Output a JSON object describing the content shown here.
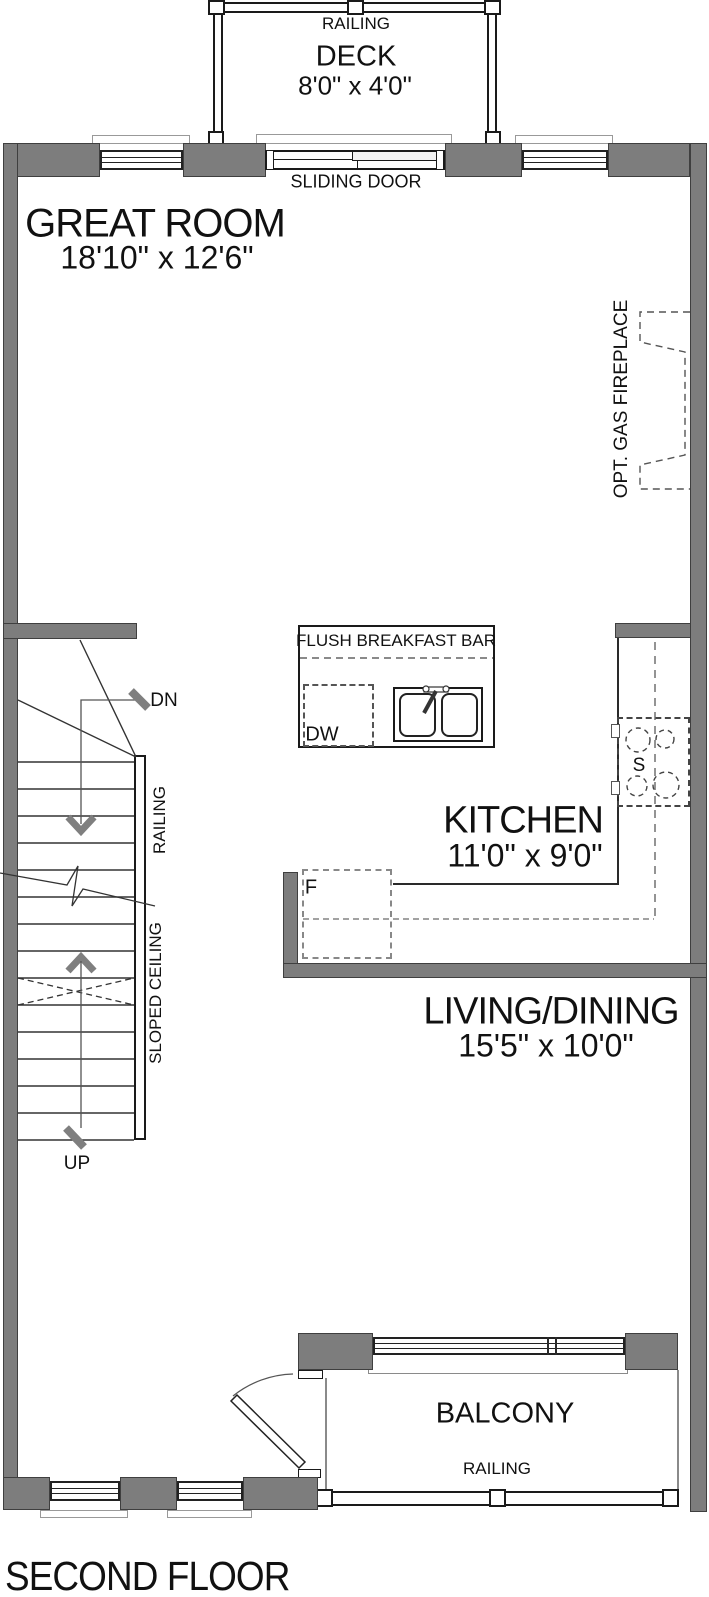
{
  "title": "SECOND FLOOR",
  "deck": {
    "name": "DECK",
    "dims": "8'0\" x 4'0\"",
    "railing": "RAILING"
  },
  "great_room": {
    "name": "GREAT ROOM",
    "dims": "18'10\" x 12'6\""
  },
  "doors": {
    "sliding": "SLIDING DOOR"
  },
  "fireplace": {
    "label": "OPT. GAS FIREPLACE"
  },
  "kitchen": {
    "name": "KITCHEN",
    "dims": "11'0\" x 9'0\"",
    "breakfast_bar": "FLUSH BREAKFAST BAR",
    "dishwasher": "DW",
    "fridge": "F",
    "stove": "S"
  },
  "living_dining": {
    "name": "LIVING/DINING",
    "dims": "15'5\" x 10'0\""
  },
  "stairs": {
    "down": "DN",
    "up": "UP",
    "railing": "RAILING",
    "sloped_ceiling": "SLOPED CEILING"
  },
  "balcony": {
    "name": "BALCONY",
    "railing": "RAILING"
  },
  "colors": {
    "wall": "#7d7d7d",
    "line": "#1a1a1a"
  }
}
